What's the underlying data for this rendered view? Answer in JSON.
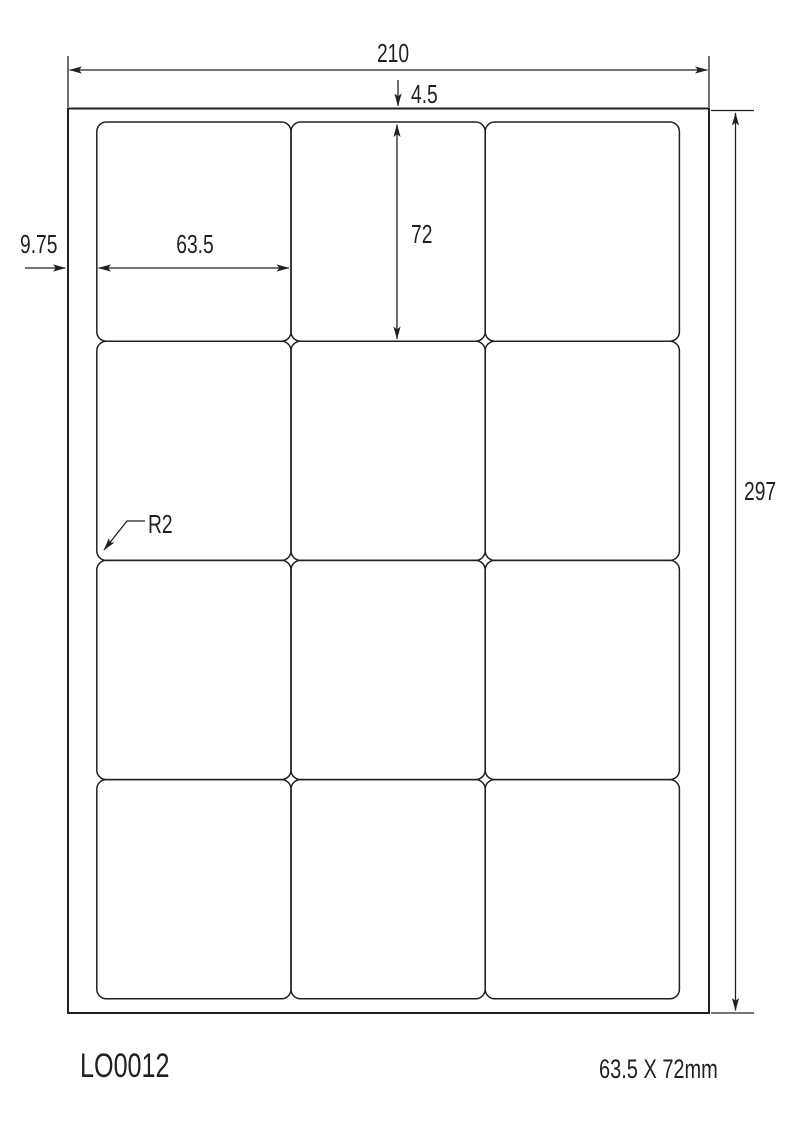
{
  "diagram": {
    "sheet_width_mm": "210",
    "sheet_height_mm": "297",
    "top_margin_mm": "4.5",
    "left_margin_mm": "9.75",
    "label_width_mm": "63.5",
    "label_height_mm": "72",
    "corner_radius_label": "R2",
    "grid": {
      "rows": 4,
      "columns": 3
    }
  },
  "footer": {
    "product_code": "LO0012",
    "label_size": "63.5 X 72mm"
  },
  "colors": {
    "line": "#231f20",
    "background": "#ffffff"
  }
}
